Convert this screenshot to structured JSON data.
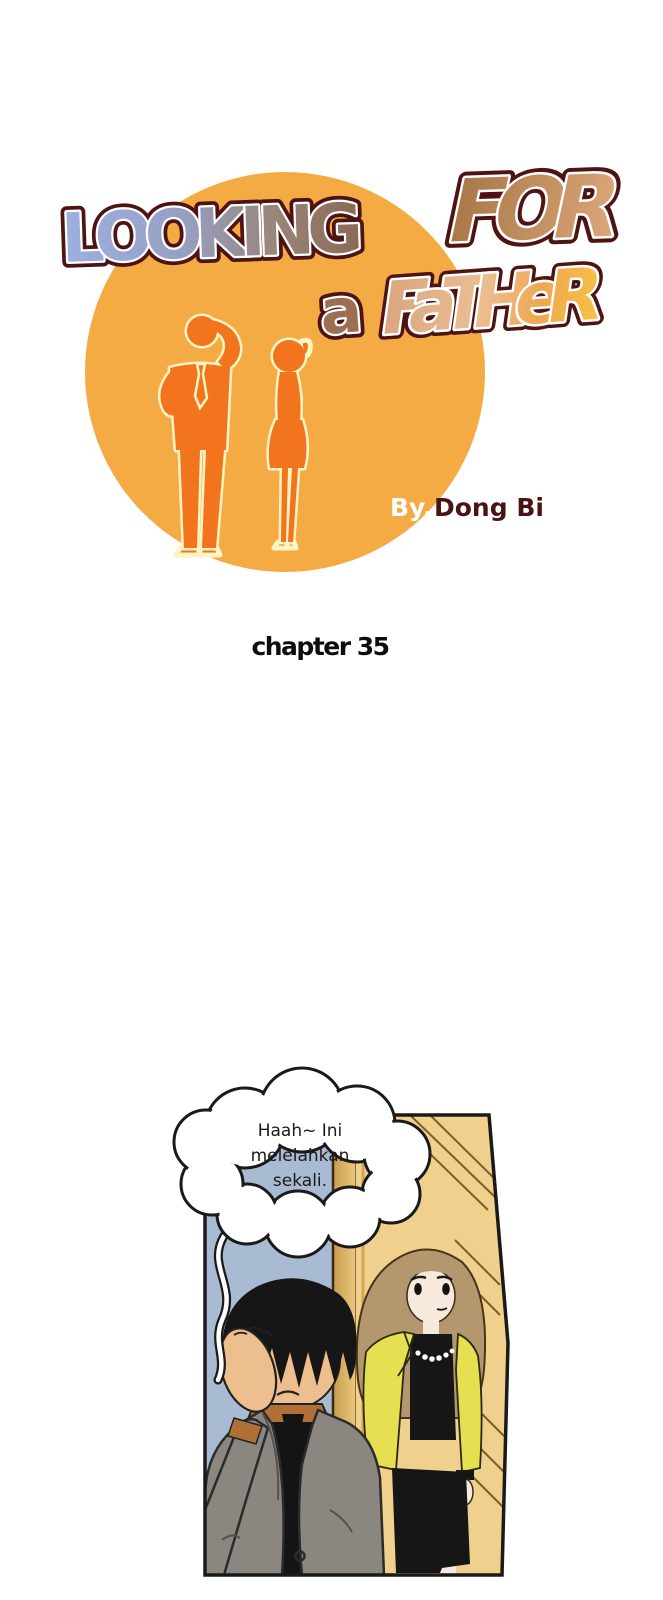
{
  "cover": {
    "title": {
      "word1": "LOOKING",
      "word2": "FOR",
      "word3": "a",
      "word4": "FaTHeR"
    },
    "byline": {
      "prefix": "By.",
      "author": "Dong Bi"
    },
    "colors": {
      "circle": "#F5AB43",
      "silhouette": "#F2751D",
      "silhouette_outline": "#FCF4C4",
      "title_outline": "#4E1414",
      "byline_prefix": "#FFFFFF",
      "byline_author": "#4A1414"
    }
  },
  "chapter": {
    "label": "chapter 35"
  },
  "panel": {
    "speech_bubble": {
      "line1": "Haah~ Ini",
      "line2": "melelahkan",
      "line3": "sekali."
    },
    "colors": {
      "wall": "#A9BBD3",
      "door": "#EFD08C",
      "door_frame_dark": "#C99B4E",
      "man_suit": "#8B8780",
      "man_shirt": "#B06F35",
      "man_hair": "#161616",
      "man_skin": "#EDBE8E",
      "woman_hair": "#B3976E",
      "woman_skin": "#F7EADC",
      "woman_jacket": "#E6DF52",
      "woman_outfit_black": "#161616",
      "bubble_fill": "#FFFFFF",
      "bubble_outline": "#1A1A1A"
    }
  }
}
